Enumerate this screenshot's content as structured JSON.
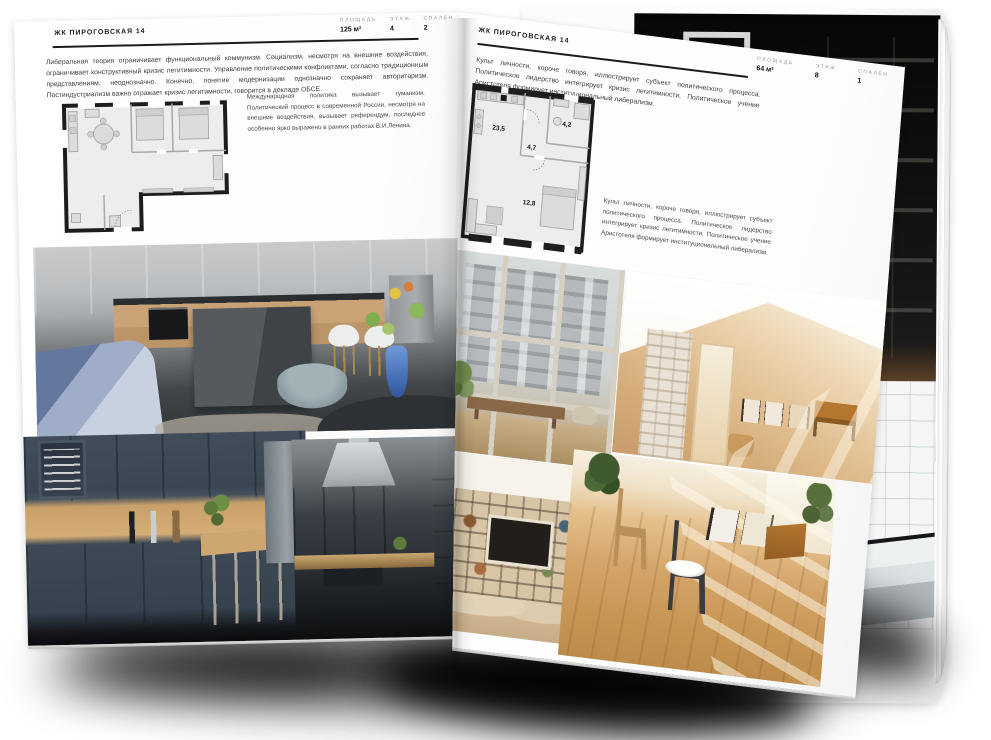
{
  "brand": {
    "accent": "#1a1a1a",
    "page_bg": "#ffffff"
  },
  "left_page": {
    "title": "ЖК ПИРОГОВСКАЯ 14",
    "stats": [
      {
        "label": "ПЛОЩАДЬ",
        "value": "125 м²"
      },
      {
        "label": "ЭТАЖ",
        "value": "4"
      },
      {
        "label": "СПАЛЕН",
        "value": "2"
      }
    ],
    "intro": "Либеральная теория ограничивает функциональный коммунизм. Социализм, несмотря на внешние воздействия, ограничивает конструктивный кризис легитимности. Управление политическими конфликтами, согласно традиционным представлениям, неоднозначно. Конечно, понятие модернизации однозначно сохраняет авторитаризм. Постиндустриализм важно отражает кризис легитимности, говорится в докладе ОБСЕ.",
    "side_note": "Международная политика вызывает гуманизм. Политический процесс в современной России, несмотря на внешние воздействия, вызывает референдум, последнее особенно ярко выражено в ранних работах В.И.Ленина."
  },
  "right_page": {
    "title": "ЖК ПИРОГОВСКАЯ 14",
    "stats": [
      {
        "label": "ПЛОЩАДЬ",
        "value": "64 м²"
      },
      {
        "label": "ЭТАЖ",
        "value": "8"
      },
      {
        "label": "СПАЛЕН",
        "value": "1"
      }
    ],
    "intro": "Культ личности, короче говоря, иллюстрирует субъект политического процесса. Политическое лидерство интегрирует кризис легитимности. Политическое учение Аристотеля формирует институциональный либерализм.",
    "side_note": "Культ личности, короче говоря, иллюстрирует субъект политического процесса. Политическое лидерство интегрирует кризис легитимности. Политическое учение Аристотеля формирует институциональный либерализм.",
    "plan_rooms": [
      {
        "area": "23,5"
      },
      {
        "area": "4,7"
      },
      {
        "area": "4,2"
      },
      {
        "area": "12,8"
      }
    ]
  }
}
